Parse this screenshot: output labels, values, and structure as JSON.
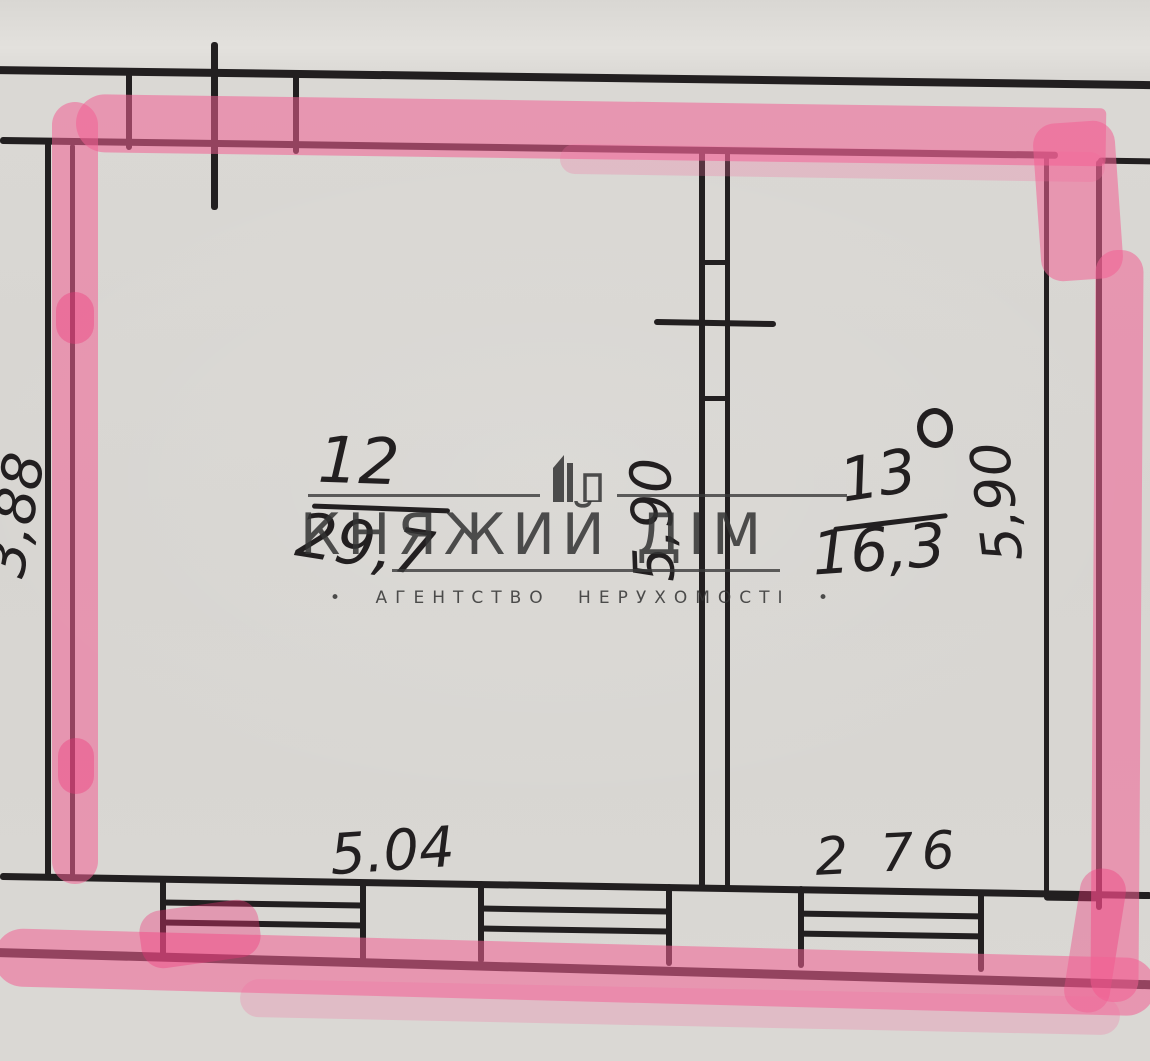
{
  "rooms": [
    {
      "number": "12",
      "area": "29,7"
    },
    {
      "number": "13",
      "area": "16,3"
    }
  ],
  "dimensions": {
    "left_height": "3,88",
    "room12_height": "5,90",
    "room13_height": "5,90",
    "room12_width": "5.04",
    "room13_width": "2 76"
  },
  "watermark": {
    "title": "КНЯЖИЙ ДІМ",
    "subtitle": "АГЕНТСТВО НЕРУХОМОСТІ",
    "bullet": "•"
  },
  "icons": {
    "watermark_building": "building-skyline-icon",
    "room13_mark": "degree-circle-icon"
  },
  "colors": {
    "paper": "#d8d6d2",
    "ink": "#221f20",
    "highlighter_pink": "#f3609a",
    "highlighter_over_ink": "#8f4462",
    "watermark_gray": "#333333"
  }
}
